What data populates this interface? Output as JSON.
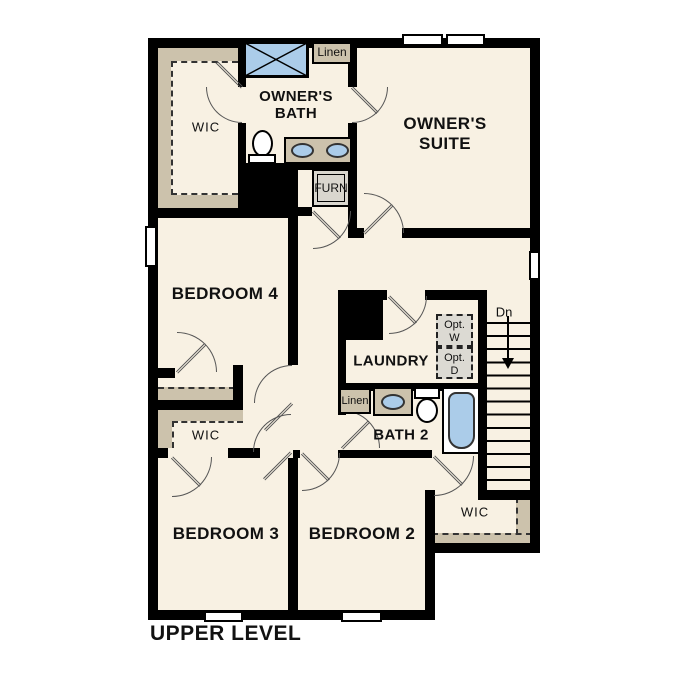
{
  "title": "UPPER LEVEL",
  "colors": {
    "wall": "#000000",
    "floor": "#F8F1E3",
    "closet_shelving_tan": "#CCC2AC",
    "fixture_blue": "#ABCCE9",
    "optional_appliance_gray": "#DCDAD3"
  },
  "rooms": {
    "wic_owners": "WIC",
    "owners_bath": "OWNER'S BATH",
    "owners_suite": "OWNER'S SUITE",
    "bedroom4": "BEDROOM 4",
    "laundry": "LAUNDRY",
    "bath2": "BATH 2",
    "bedroom3": "BEDROOM 3",
    "bedroom2": "BEDROOM 2",
    "wic_bedroom3": "WIC",
    "wic_bedroom2": "WIC"
  },
  "closets": {
    "linen_upper": "Linen",
    "linen_bath2": "Linen",
    "furnace": "FURN"
  },
  "stairs": {
    "direction_label": "Dn"
  },
  "optional_appliances": {
    "washer": {
      "line1": "Opt.",
      "line2": "W"
    },
    "dryer": {
      "line1": "Opt.",
      "line2": "D"
    }
  }
}
